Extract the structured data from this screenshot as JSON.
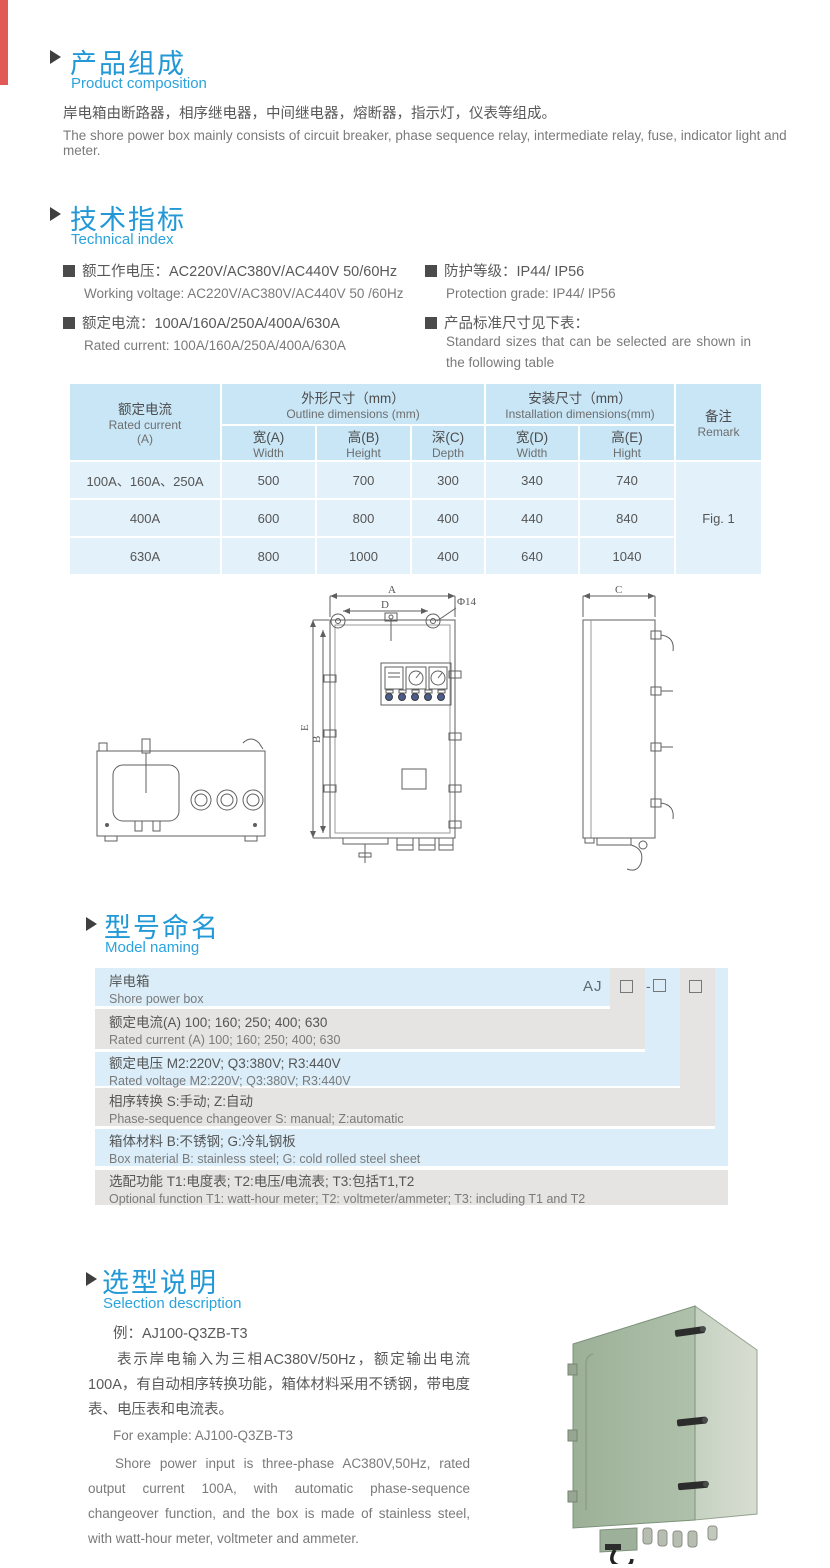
{
  "colors": {
    "accent_blue": "#2298d6",
    "subtitle_blue": "#2aa3dc",
    "table_header_bg": "#c8e6f6",
    "table_body_bg": "#e2f1fa",
    "model_blue": "#daedf8",
    "model_gray": "#e5e4e2",
    "red_edge_tab": "#e25a56",
    "photo_green": "#a5b9a1"
  },
  "composition": {
    "title_zh": "产品组成",
    "title_en": "Product  composition",
    "body_zh": "岸电箱由断路器，相序继电器，中间继电器，熔断器，指示灯，仪表等组成。",
    "body_en": "The shore power box mainly consists of circuit breaker, phase sequence relay, intermediate relay, fuse, indicator light and meter."
  },
  "technical": {
    "title_zh": "技术指标",
    "title_en": "Technical index",
    "specs": [
      {
        "zh": "额工作电压：AC220V/AC380V/AC440V  50/60Hz",
        "en": "Working voltage: AC220V/AC380V/AC440V 50 /60Hz"
      },
      {
        "zh": "额定电流：100A/160A/250A/400A/630A",
        "en": "Rated current: 100A/160A/250A/400A/630A"
      },
      {
        "zh": "防护等级：IP44/ IP56",
        "en": "Protection grade: IP44/ IP56"
      },
      {
        "zh": "产品标准尺寸见下表：",
        "en": "Standard sizes that can be selected are shown in the following table"
      }
    ]
  },
  "dim_table": {
    "col1_header": [
      "额定电流",
      "Rated current",
      "(A)"
    ],
    "outline_header": [
      "外形尺寸（mm）",
      "Outline dimensions (mm)"
    ],
    "install_header": [
      "安装尺寸（mm）",
      "Installation dimensions(mm)"
    ],
    "remark_header": [
      "备注",
      "Remark"
    ],
    "sub_headers": [
      [
        "宽(A)",
        "Width"
      ],
      [
        "高(B)",
        "Height"
      ],
      [
        "深(C)",
        "Depth"
      ],
      [
        "宽(D)",
        "Width"
      ],
      [
        "高(E)",
        "Hight"
      ]
    ],
    "rows": [
      {
        "current": "100A、160A、250A",
        "values": [
          "500",
          "700",
          "300",
          "340",
          "740"
        ]
      },
      {
        "current": "400A",
        "values": [
          "600",
          "800",
          "400",
          "440",
          "840"
        ]
      },
      {
        "current": "630A",
        "values": [
          "800",
          "1000",
          "400",
          "640",
          "1040"
        ]
      }
    ],
    "remark_value": "Fig. 1"
  },
  "drawing": {
    "labels": {
      "a": "A",
      "b": "B",
      "c": "C",
      "d": "D",
      "e": "E",
      "hole": "Φ14"
    }
  },
  "model_naming": {
    "title_zh": "型号命名",
    "title_en": "Model naming",
    "code_prefix": "AJ",
    "code_dash": "-",
    "rows": [
      {
        "zh": "岸电箱",
        "en": "Shore power box"
      },
      {
        "zh": "额定电流(A)  100; 160; 250; 400; 630",
        "en": "Rated current (A) 100; 160; 250; 400; 630"
      },
      {
        "zh": "额定电压   M2:220V;  Q3:380V;  R3:440V",
        "en": "Rated voltage  M2:220V;  Q3:380V;  R3:440V"
      },
      {
        "zh": "相序转换  S:手动; Z:自动",
        "en": "Phase-sequence changeover  S: manual;  Z:automatic"
      },
      {
        "zh": "箱体材料    B:不锈钢;  G:冷轧钢板",
        "en": "Box material   B: stainless steel; G: cold rolled steel sheet"
      },
      {
        "zh": "选配功能      T1:电度表;  T2:电压/电流表; T3:包括T1,T2",
        "en": "Optional function  T1: watt-hour meter; T2: voltmeter/ammeter; T3: including T1 and T2"
      }
    ]
  },
  "selection": {
    "title_zh": "选型说明",
    "title_en": "Selection description",
    "example_zh": "例：AJ100-Q3ZB-T3",
    "para_zh": "表示岸电输入为三相AC380V/50Hz，额定输出电流100A，有自动相序转换功能，箱体材料采用不锈钢，带电度表、电压表和电流表。",
    "example_en": "For example: AJ100-Q3ZB-T3",
    "para_en": "Shore power input is three-phase AC380V,50Hz, rated output current 100A, with automatic phase-sequence changeover function, and the box is made of stainless steel, with watt-hour meter, voltmeter and ammeter."
  }
}
